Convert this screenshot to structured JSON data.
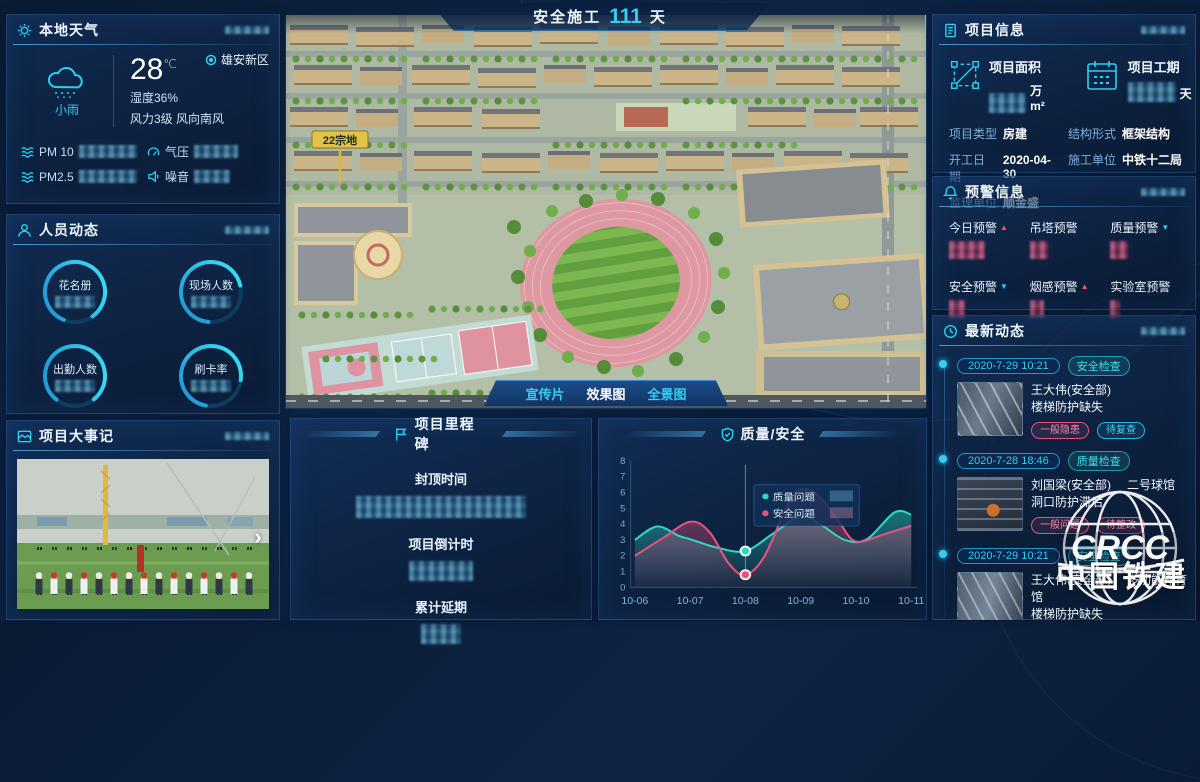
{
  "banner": {
    "label": "安全施工",
    "days": "111",
    "unit": "天"
  },
  "weather": {
    "title": "本地天气",
    "region": "雄安新区",
    "condition": "小雨",
    "temperature": "28",
    "temp_unit": "℃",
    "humidity": "湿度36%",
    "wind": "风力3级 风向南风",
    "metrics": [
      {
        "label": "PM 10"
      },
      {
        "label": "气压"
      },
      {
        "label": "PM2.5"
      },
      {
        "label": "噪音"
      }
    ]
  },
  "personnel": {
    "title": "人员动态",
    "gauges": [
      {
        "label": "花名册"
      },
      {
        "label": "现场人数"
      },
      {
        "label": "出勤人数"
      },
      {
        "label": "刷卡率"
      }
    ]
  },
  "events": {
    "title": "项目大事记"
  },
  "main_view": {
    "plot_sign": "22宗地",
    "tabs": [
      {
        "label": "宣传片"
      },
      {
        "label": "效果图"
      },
      {
        "label": "全景图"
      }
    ],
    "active_tab": "效果图"
  },
  "milestone": {
    "title": "项目里程碑",
    "items": [
      {
        "label": "封顶时间"
      },
      {
        "label": "项目倒计时"
      },
      {
        "label": "累计延期"
      }
    ]
  },
  "quality_panel": {
    "title": "质量/安全"
  },
  "chart_data": {
    "type": "area",
    "title": "质量/安全",
    "x_labels": [
      "10-06",
      "10-07",
      "10-08",
      "10-09",
      "10-10",
      "10-11"
    ],
    "ylim": [
      0,
      8
    ],
    "y_ticks": [
      0,
      1,
      2,
      3,
      4,
      5,
      6,
      7,
      8
    ],
    "grid": false,
    "series": [
      {
        "name": "质量问题",
        "color": "#2ed9c3",
        "points": [
          [
            0,
            3.0
          ],
          [
            0.4,
            3.85
          ],
          [
            0.8,
            3.25
          ],
          [
            1,
            3.05
          ],
          [
            1.5,
            2.5
          ],
          [
            2,
            2.3
          ],
          [
            2.5,
            3.4
          ],
          [
            3,
            4.5
          ],
          [
            3.35,
            4.0
          ],
          [
            3.8,
            3.0
          ],
          [
            4.2,
            3.05
          ],
          [
            4.7,
            4.75
          ],
          [
            5,
            4.6
          ]
        ]
      },
      {
        "name": "安全问题",
        "color": "#e8537e",
        "points": [
          [
            0,
            2.0
          ],
          [
            0.5,
            3.1
          ],
          [
            1,
            4.15
          ],
          [
            1.35,
            3.5
          ],
          [
            1.7,
            1.5
          ],
          [
            2,
            0.8
          ],
          [
            2.35,
            2.0
          ],
          [
            2.8,
            5.5
          ],
          [
            3.05,
            6.2
          ],
          [
            3.35,
            5.7
          ],
          [
            3.7,
            4.1
          ],
          [
            4,
            2.9
          ],
          [
            4.5,
            3.35
          ],
          [
            5,
            3.9
          ]
        ]
      }
    ],
    "highlight": {
      "x_label": "10-08",
      "x_index": 2,
      "quality_value": 2.3,
      "safety_value": 0.8
    }
  },
  "project_info": {
    "title": "项目信息",
    "stats": [
      {
        "label": "项目面积",
        "unit": "万m²"
      },
      {
        "label": "项目工期",
        "unit": "天"
      }
    ],
    "fields": [
      {
        "label": "项目类型",
        "value": "房建"
      },
      {
        "label": "结构形式",
        "value": "框架结构"
      },
      {
        "label": "开工日期",
        "value": "2020-04-30"
      },
      {
        "label": "施工单位",
        "value": "中铁十二局"
      },
      {
        "label": "监理单位",
        "value": "顺金盛"
      }
    ]
  },
  "warnings": {
    "title": "预警信息",
    "items": [
      {
        "label": "今日预警",
        "trend": "up"
      },
      {
        "label": "吊塔预警",
        "trend": ""
      },
      {
        "label": "质量预警",
        "trend": "down"
      },
      {
        "label": "安全预警",
        "trend": "down"
      },
      {
        "label": "烟感预警",
        "trend": "up"
      },
      {
        "label": "实验室预警",
        "trend": ""
      }
    ]
  },
  "updates": {
    "title": "最新动态",
    "items": [
      {
        "date": "2020-7-29 10:21",
        "category": "安全检查",
        "person": "王大伟(安全部)",
        "location": "",
        "issue": "楼梯防护缺失",
        "tags": [
          {
            "text": "一般隐患",
            "color": "pink"
          },
          {
            "text": "待复查",
            "color": "cyan"
          }
        ]
      },
      {
        "date": "2020-7-28 18:46",
        "category": "质量检查",
        "person": "刘国梁(安全部)",
        "location": "二号球馆",
        "issue": "洞口防护滞后",
        "tags": [
          {
            "text": "一般问题",
            "color": "pink"
          },
          {
            "text": "待整改",
            "color": "pink"
          }
        ]
      },
      {
        "date": "2020-7-29 10:21",
        "category": "安全检查",
        "person": "王大伟(安全部)",
        "location": "多功能体育馆",
        "issue": "楼梯防护缺失",
        "tags": [
          {
            "text": "一般隐患",
            "color": "pink"
          },
          {
            "text": "待复查",
            "color": "cyan"
          }
        ]
      },
      {
        "date": "2020-7-28 18:46",
        "category": "质量检查",
        "person": "刘国梁(安全部)",
        "location": "",
        "issue": "",
        "tags": []
      }
    ]
  },
  "logo": {
    "abbr": "CRCC",
    "name": "中国铁建"
  },
  "colors": {
    "accent": "#2ad0f0",
    "teal": "#2ed9c3",
    "pink": "#e8537e",
    "alert_up": "#ff5a5a"
  }
}
